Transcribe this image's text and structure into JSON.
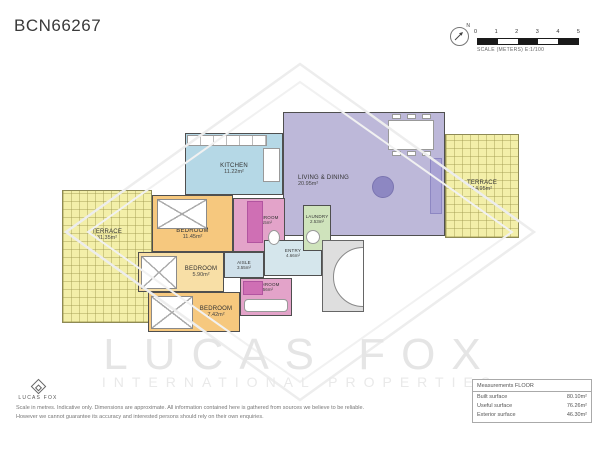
{
  "title": "BCN66267",
  "scale_bar": {
    "ticks": [
      "0",
      "1",
      "2",
      "3",
      "4",
      "5"
    ],
    "caption": "SCALE (METERS) E:1/100",
    "north_label": "N"
  },
  "rooms": [
    {
      "name": "TERRACE",
      "area": "31.35m²"
    },
    {
      "name": "TERRACE",
      "area": "14.95m²"
    },
    {
      "name": "KITCHEN",
      "area": "11.22m²"
    },
    {
      "name": "LIVING & DINING",
      "area": "20.95m²"
    },
    {
      "name": "BEDROOM",
      "area": "11.45m²"
    },
    {
      "name": "BEDROOM",
      "area": "5.90m²"
    },
    {
      "name": "BEDROOM",
      "area": "7.42m²"
    },
    {
      "name": "BATHROOM",
      "area": "4.15m²"
    },
    {
      "name": "BATHROOM",
      "area": "3.56m²"
    },
    {
      "name": "AISLE",
      "area": "3.55m²"
    },
    {
      "name": "ENTRY",
      "area": "4.66m²"
    },
    {
      "name": "LAUNDRY",
      "area": "2.53m²"
    }
  ],
  "watermark": {
    "line1": "LUCAS FOX",
    "line2": "INTERNATIONAL PROPERTIES"
  },
  "measurements": {
    "header": "Measurements FLOOR",
    "rows": [
      {
        "label": "Built surface",
        "value": "80.10m²"
      },
      {
        "label": "Useful surface",
        "value": "76.26m²"
      },
      {
        "label": "Exterior surface",
        "value": "46.30m²"
      }
    ]
  },
  "footer": {
    "brand": "LUCAS FOX",
    "disclaimer_line1": "Scale in metres. Indicative only. Dimensions are approximate. All information contained here is gathered from sources we believe to be reliable.",
    "disclaimer_line2": "However we cannot guarantee its accuracy and interested persons should rely on their own enquiries."
  },
  "colors": {
    "terrace": "#f3efa9",
    "kitchen": "#b5d8e6",
    "living": "#bdb8d9",
    "bedroom": "#f6c87e",
    "bathroom": "#e3a3c9",
    "bathroom_dark": "#cf6fb4",
    "aisle": "#cfe0ea",
    "entry": "#d5e6ec",
    "laundry": "#cfe3bc",
    "walls": "#555555"
  }
}
